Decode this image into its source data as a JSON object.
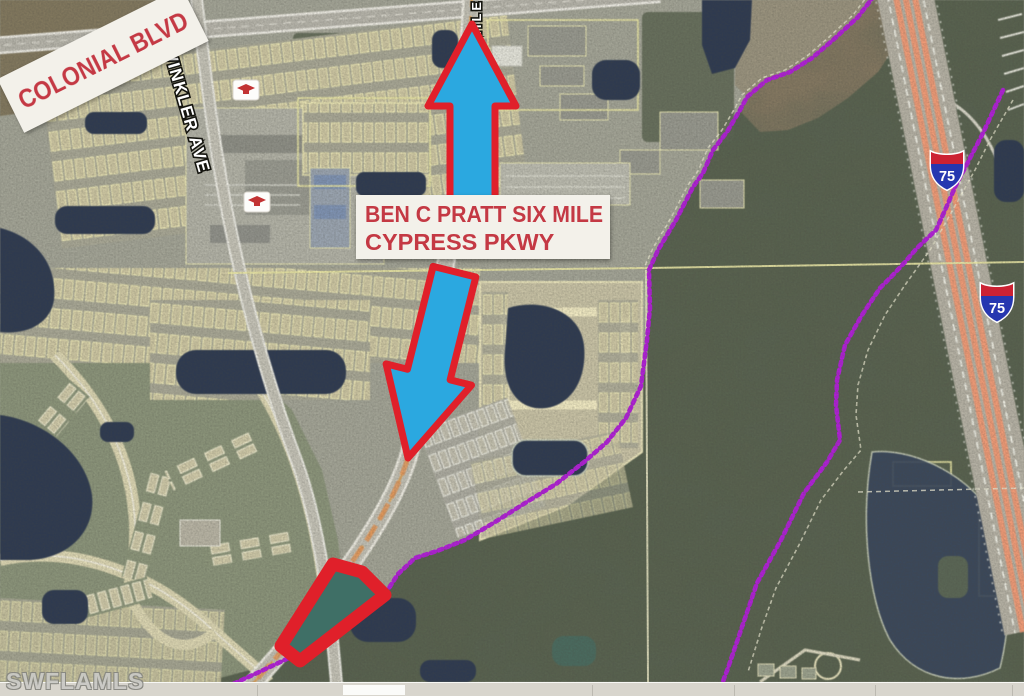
{
  "colors": {
    "annotation-red": "#e0202a",
    "label-red": "#c43944",
    "arrow-blue": "#2ba8e0",
    "boundary-purple": "#b01fd6",
    "shield-blue": "#2637b0",
    "shield-red": "#cc2233",
    "parcel-yellow": "#e9e6a4",
    "highway-salmon": "#ef9a76",
    "banner-white": "#f3f1ea",
    "watermark-gray": "#c9c9c5"
  },
  "annotations": {
    "banner": {
      "text": "COLONIAL BLVD"
    },
    "parkway_label": {
      "line1": "BEN C PRATT SIX MILE",
      "line2": "CYPRESS PKWY"
    },
    "shields": [
      {
        "label": "75"
      },
      {
        "label": "75"
      }
    ],
    "arrows": [
      {
        "direction": "up"
      },
      {
        "direction": "down-left"
      }
    ]
  },
  "road_labels": {
    "winkler": "WINKLER AVE",
    "six_mile_fragment": "MILE"
  },
  "watermark": {
    "text": "SWFLAMLS"
  }
}
